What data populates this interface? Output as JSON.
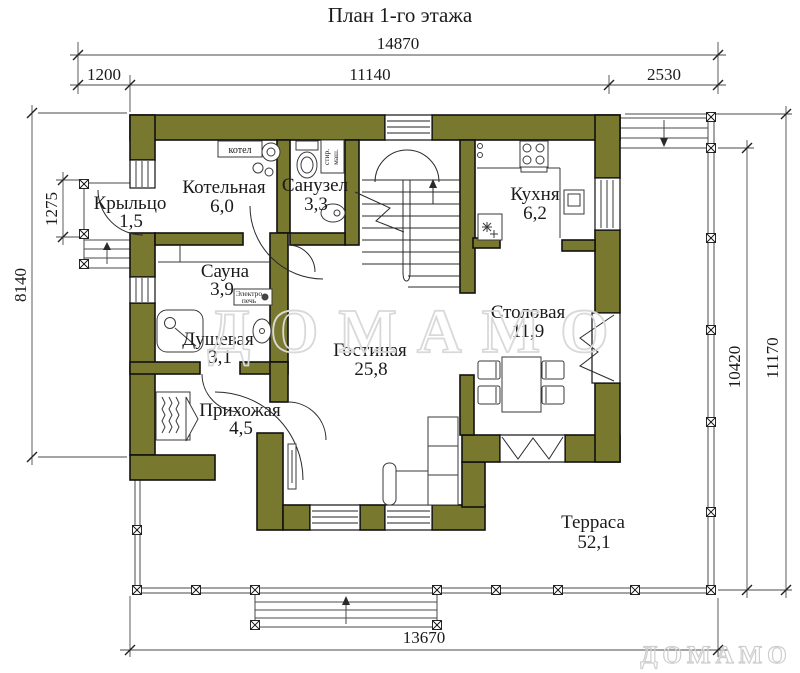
{
  "title": "План 1-го этажа",
  "watermark": {
    "center_text": "ДОМАМО",
    "corner_text": "ДОМАМО"
  },
  "colors": {
    "wall_fill": "#78782f",
    "line": "#1a1a1a",
    "watermark_stroke": "#d9d9d9"
  },
  "dims": {
    "top_total": "14870",
    "top_segments": [
      "1200",
      "11140",
      "2530"
    ],
    "left_outer": "8140",
    "left_inner": "1275",
    "right_inner": "10420",
    "right_outer": "11170",
    "bottom_total": "13670"
  },
  "rooms": [
    {
      "name": "Котельная",
      "area": "6,0"
    },
    {
      "name": "Санузел",
      "area": "3,3"
    },
    {
      "name": "Кухня",
      "area": "6,2"
    },
    {
      "name": "Крыльцо",
      "area": "1,5"
    },
    {
      "name": "Сауна",
      "area": "3,9"
    },
    {
      "name": "Душевая",
      "area": "3,1"
    },
    {
      "name": "Прихожая",
      "area": "4,5"
    },
    {
      "name": "Гостиная",
      "area": "25,8"
    },
    {
      "name": "Столовая",
      "area": "11,9"
    },
    {
      "name": "Терраса",
      "area": "52,1"
    }
  ],
  "equipment_labels": {
    "boiler": "котел",
    "washer_line1": "стир.",
    "washer_line2": "маш.",
    "sauna_stove_line1": "Электро",
    "sauna_stove_line2": "печь"
  }
}
